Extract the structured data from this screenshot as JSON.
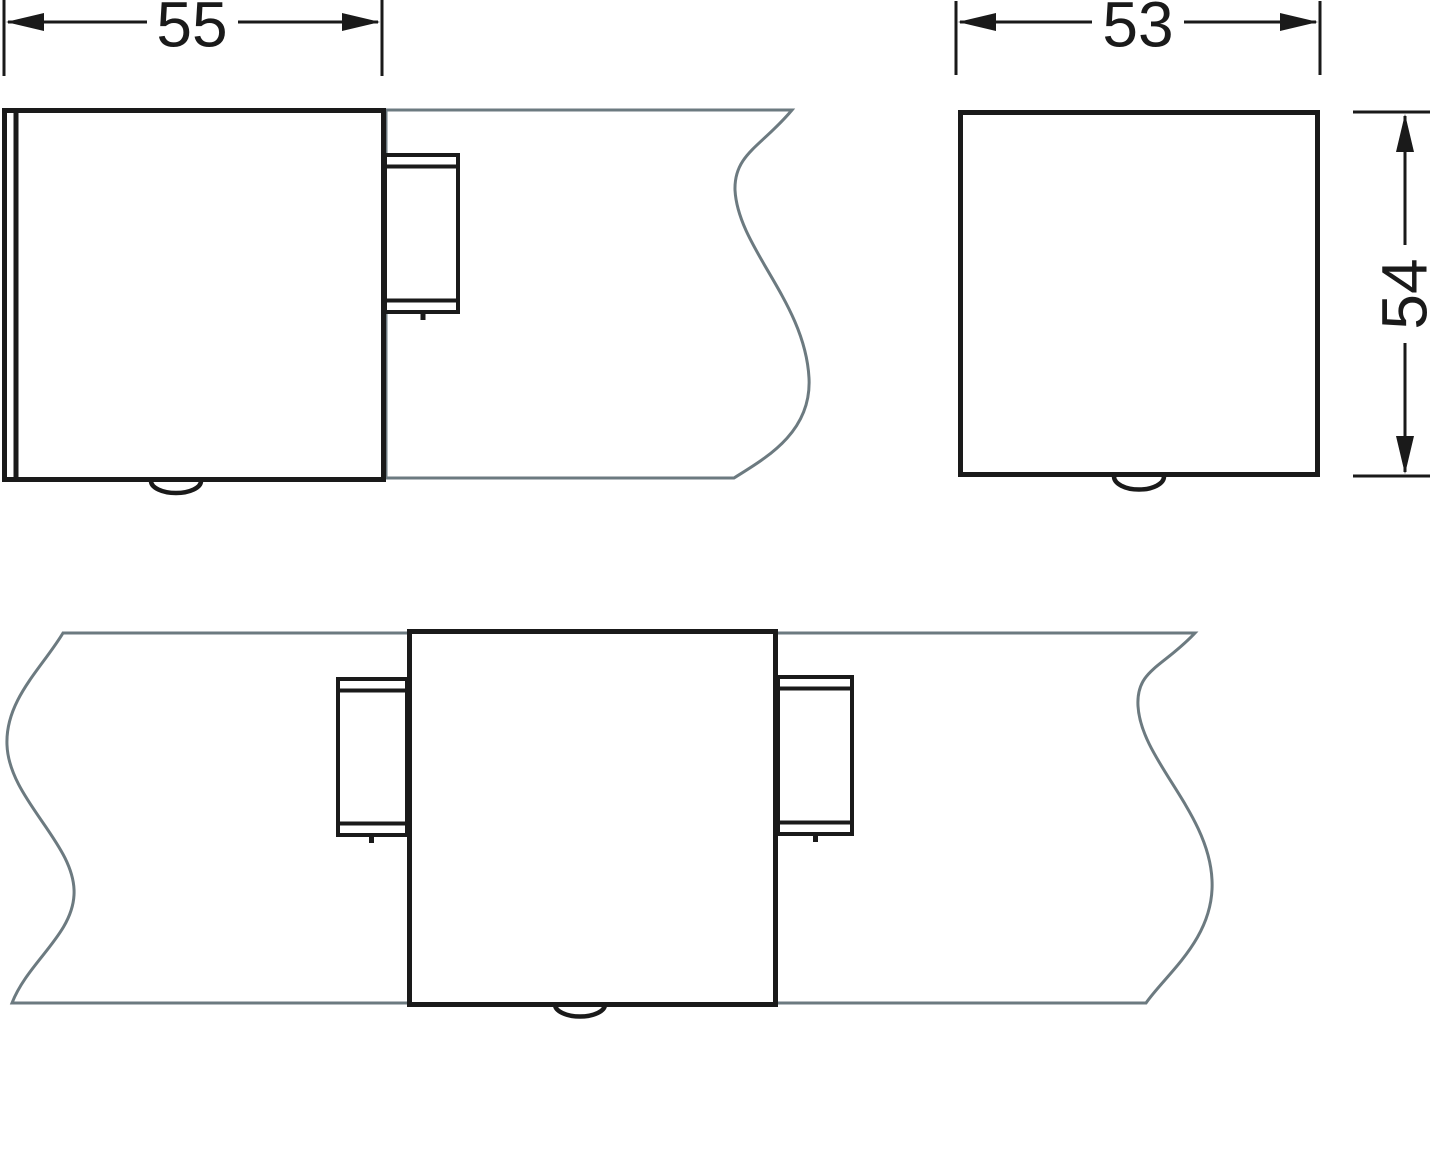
{
  "drawing": {
    "type": "technical-dimension-drawing",
    "views": {
      "side_view": {
        "dim_width_label": "55"
      },
      "end_view": {
        "dim_width_label": "53",
        "dim_height_label": "54"
      },
      "plan_view": {}
    },
    "colors": {
      "line": "#1a1a1a",
      "profile": "#6c7a80",
      "background": "#ffffff"
    }
  }
}
